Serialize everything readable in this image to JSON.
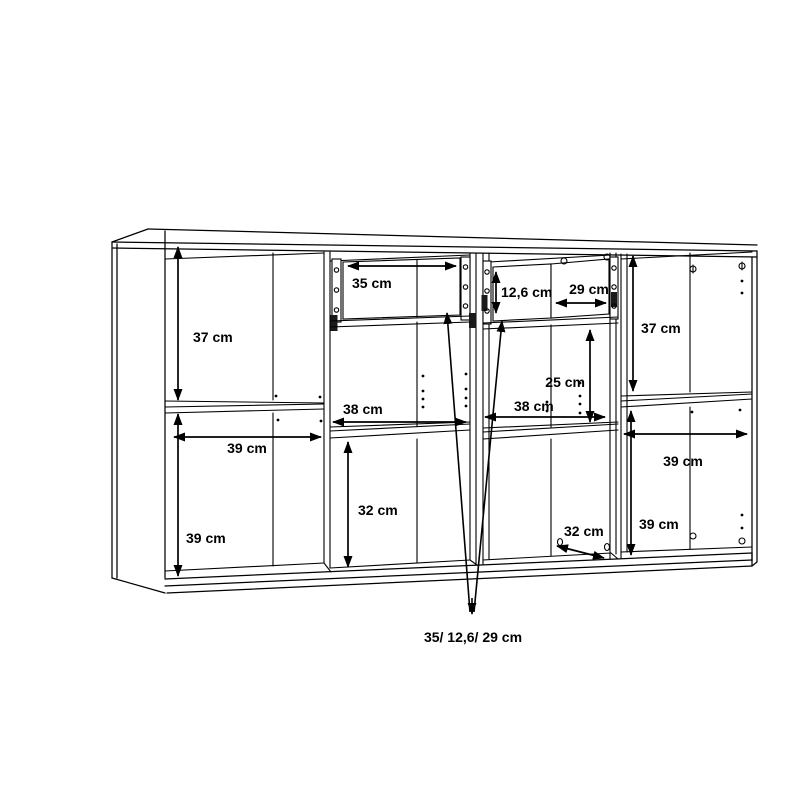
{
  "meta": {
    "title": "Sideboard assembly dimension diagram",
    "description": "Line drawing of a four-compartment sideboard with two top drawers, annotated with interior dimensions",
    "background_color": "#ffffff",
    "line_color": "#000000",
    "text_color": "#000000",
    "unit": "cm"
  },
  "labels": {
    "s1_height_top": "37 cm",
    "s1_width": "39 cm",
    "s1_height_bottom": "39 cm",
    "s2_drawer_width": "35 cm",
    "s2_width": "38 cm",
    "s2_height_bottom": "32 cm",
    "s3_drawer_front_height": "12,6 cm",
    "s3_drawer_width": "29 cm",
    "s3_height_top": "25 cm",
    "s3_width": "38 cm",
    "s3_depth": "32 cm",
    "s4_height_top": "37 cm",
    "s4_width": "39 cm",
    "s4_height_bottom": "39 cm",
    "drawer_sizes_callout": "35/ 12,6/ 29 cm"
  }
}
